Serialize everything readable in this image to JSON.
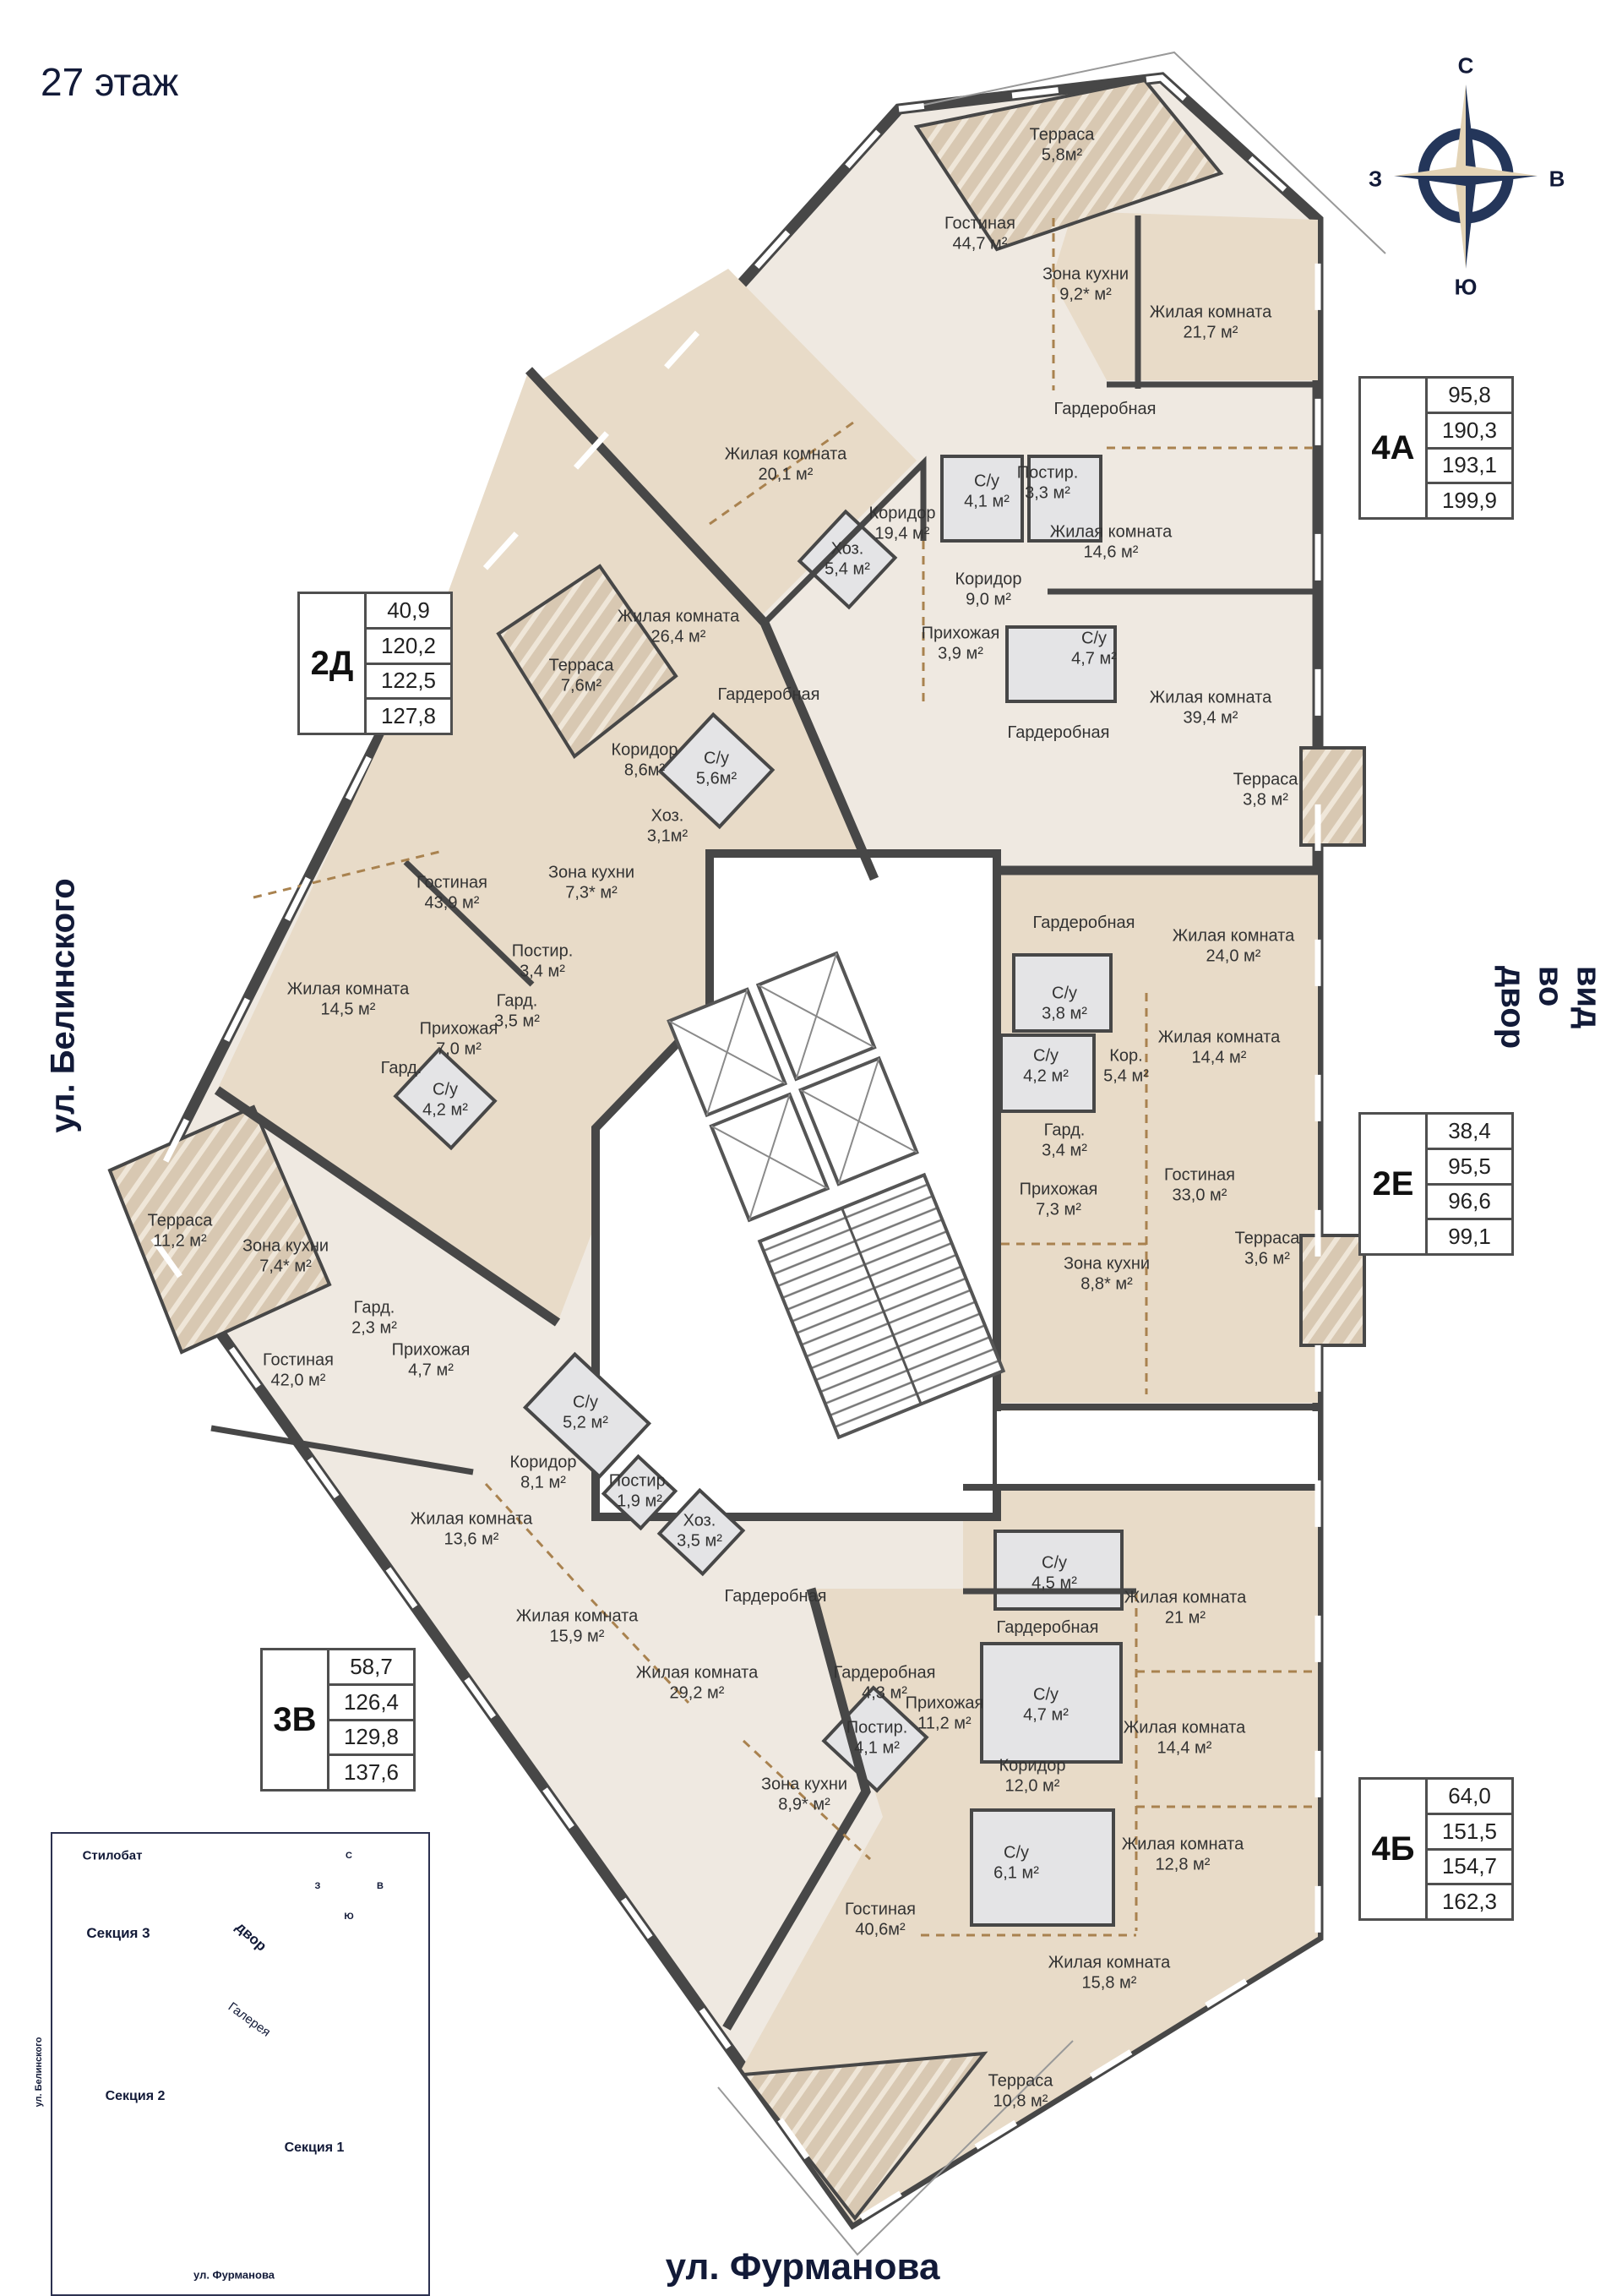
{
  "page": {
    "title": "27 этаж"
  },
  "streets": {
    "left": "ул. Белинского",
    "right": "вид во двор",
    "bottom": "ул. Фурманова"
  },
  "compass": {
    "north": "С",
    "south": "Ю",
    "west": "З",
    "east": "В"
  },
  "units": [
    {
      "id": "2Д",
      "areas": [
        "40,9",
        "120,2",
        "122,5",
        "127,8"
      ]
    },
    {
      "id": "4А",
      "areas": [
        "95,8",
        "190,3",
        "193,1",
        "199,9"
      ]
    },
    {
      "id": "2Е",
      "areas": [
        "38,4",
        "95,5",
        "96,6",
        "99,1"
      ]
    },
    {
      "id": "3В",
      "areas": [
        "58,7",
        "126,4",
        "129,8",
        "137,6"
      ]
    },
    {
      "id": "4Б",
      "areas": [
        "64,0",
        "151,5",
        "154,7",
        "162,3"
      ]
    }
  ],
  "rooms": [
    {
      "n": "Терраса",
      "a": "5,8м²"
    },
    {
      "n": "Гостиная",
      "a": "44,7 м²"
    },
    {
      "n": "Зона кухни",
      "a": "9,2* м²"
    },
    {
      "n": "Жилая комната",
      "a": "21,7 м²"
    },
    {
      "n": "Гардеробная",
      "a": ""
    },
    {
      "n": "Жилая комната",
      "a": "20,1 м²"
    },
    {
      "n": "С/у",
      "a": "4,1 м²"
    },
    {
      "n": "Постир.",
      "a": "3,3 м²"
    },
    {
      "n": "Коридор",
      "a": "19,4 м²"
    },
    {
      "n": "Жилая комната",
      "a": "14,6 м²"
    },
    {
      "n": "Коридор",
      "a": "9,0 м²"
    },
    {
      "n": "Хоз.",
      "a": "5,4 м²"
    },
    {
      "n": "Прихожая",
      "a": "3,9 м²"
    },
    {
      "n": "С/у",
      "a": "4,7 м²"
    },
    {
      "n": "Жилая комната",
      "a": "39,4 м²"
    },
    {
      "n": "Гардеробная",
      "a": ""
    },
    {
      "n": "Терраса",
      "a": "3,8 м²"
    },
    {
      "n": "Жилая комната",
      "a": "26,4 м²"
    },
    {
      "n": "Терраса",
      "a": "7,6м²"
    },
    {
      "n": "Гардеробная",
      "a": ""
    },
    {
      "n": "Коридор",
      "a": "8,6м²"
    },
    {
      "n": "С/у",
      "a": "5,6м²"
    },
    {
      "n": "Хоз.",
      "a": "3,1м²"
    },
    {
      "n": "Гостиная",
      "a": "43,9 м²"
    },
    {
      "n": "Зона кухни",
      "a": "7,3* м²"
    },
    {
      "n": "Постир.",
      "a": "3,4 м²"
    },
    {
      "n": "Гард.",
      "a": "3,5 м²"
    },
    {
      "n": "Жилая комната",
      "a": "14,5 м²"
    },
    {
      "n": "Прихожая",
      "a": "7,0 м²"
    },
    {
      "n": "Гард.",
      "a": ""
    },
    {
      "n": "С/у",
      "a": "4,2 м²"
    },
    {
      "n": "Гардеробная",
      "a": ""
    },
    {
      "n": "Жилая комната",
      "a": "24,0 м²"
    },
    {
      "n": "С/у",
      "a": "3,8 м²"
    },
    {
      "n": "С/у",
      "a": "4,2 м²"
    },
    {
      "n": "Кор.",
      "a": "5,4 м²"
    },
    {
      "n": "Жилая комната",
      "a": "14,4 м²"
    },
    {
      "n": "Гард.",
      "a": "3,4 м²"
    },
    {
      "n": "Прихожая",
      "a": "7,3 м²"
    },
    {
      "n": "Гостиная",
      "a": "33,0 м²"
    },
    {
      "n": "Зона кухни",
      "a": "8,8* м²"
    },
    {
      "n": "Терраса",
      "a": "3,6 м²"
    },
    {
      "n": "Терраса",
      "a": "11,2 м²"
    },
    {
      "n": "Зона кухни",
      "a": "7,4* м²"
    },
    {
      "n": "Гард.",
      "a": "2,3 м²"
    },
    {
      "n": "Прихожая",
      "a": "4,7 м²"
    },
    {
      "n": "Гостиная",
      "a": "42,0 м²"
    },
    {
      "n": "С/у",
      "a": "5,2 м²"
    },
    {
      "n": "Коридор",
      "a": "8,1 м²"
    },
    {
      "n": "Постир.",
      "a": "1,9 м²"
    },
    {
      "n": "Хоз.",
      "a": "3,5 м²"
    },
    {
      "n": "Жилая комната",
      "a": "13,6 м²"
    },
    {
      "n": "Жилая комната",
      "a": "15,9 м²"
    },
    {
      "n": "Гардеробная",
      "a": ""
    },
    {
      "n": "Жилая комната",
      "a": "29,2 м²"
    },
    {
      "n": "С/у",
      "a": "4,5 м²"
    },
    {
      "n": "Жилая комната",
      "a": "21 м²"
    },
    {
      "n": "Гардеробная",
      "a": ""
    },
    {
      "n": "Гардеробная",
      "a": "4,3 м²"
    },
    {
      "n": "Прихожая",
      "a": "11,2 м²"
    },
    {
      "n": "С/у",
      "a": "4,7 м²"
    },
    {
      "n": "Постир.",
      "a": "4,1 м²"
    },
    {
      "n": "Коридор",
      "a": "12,0 м²"
    },
    {
      "n": "Жилая комната",
      "a": "14,4 м²"
    },
    {
      "n": "С/у",
      "a": "6,1 м²"
    },
    {
      "n": "Жилая комната",
      "a": "12,8 м²"
    },
    {
      "n": "Зона кухни",
      "a": "8,9* м²"
    },
    {
      "n": "Гостиная",
      "a": "40,6м²"
    },
    {
      "n": "Жилая комната",
      "a": "15,8 м²"
    },
    {
      "n": "Терраса",
      "a": "10,8 м²"
    }
  ],
  "sitemap": {
    "stylobate": "Стилобат",
    "section3": "Секция 3",
    "section2": "Секция 2",
    "section1": "Секция 1",
    "yard": "двор",
    "gallery": "Галерея",
    "street_left": "ул. Белинского",
    "street_bottom": "ул. Фурманова"
  }
}
